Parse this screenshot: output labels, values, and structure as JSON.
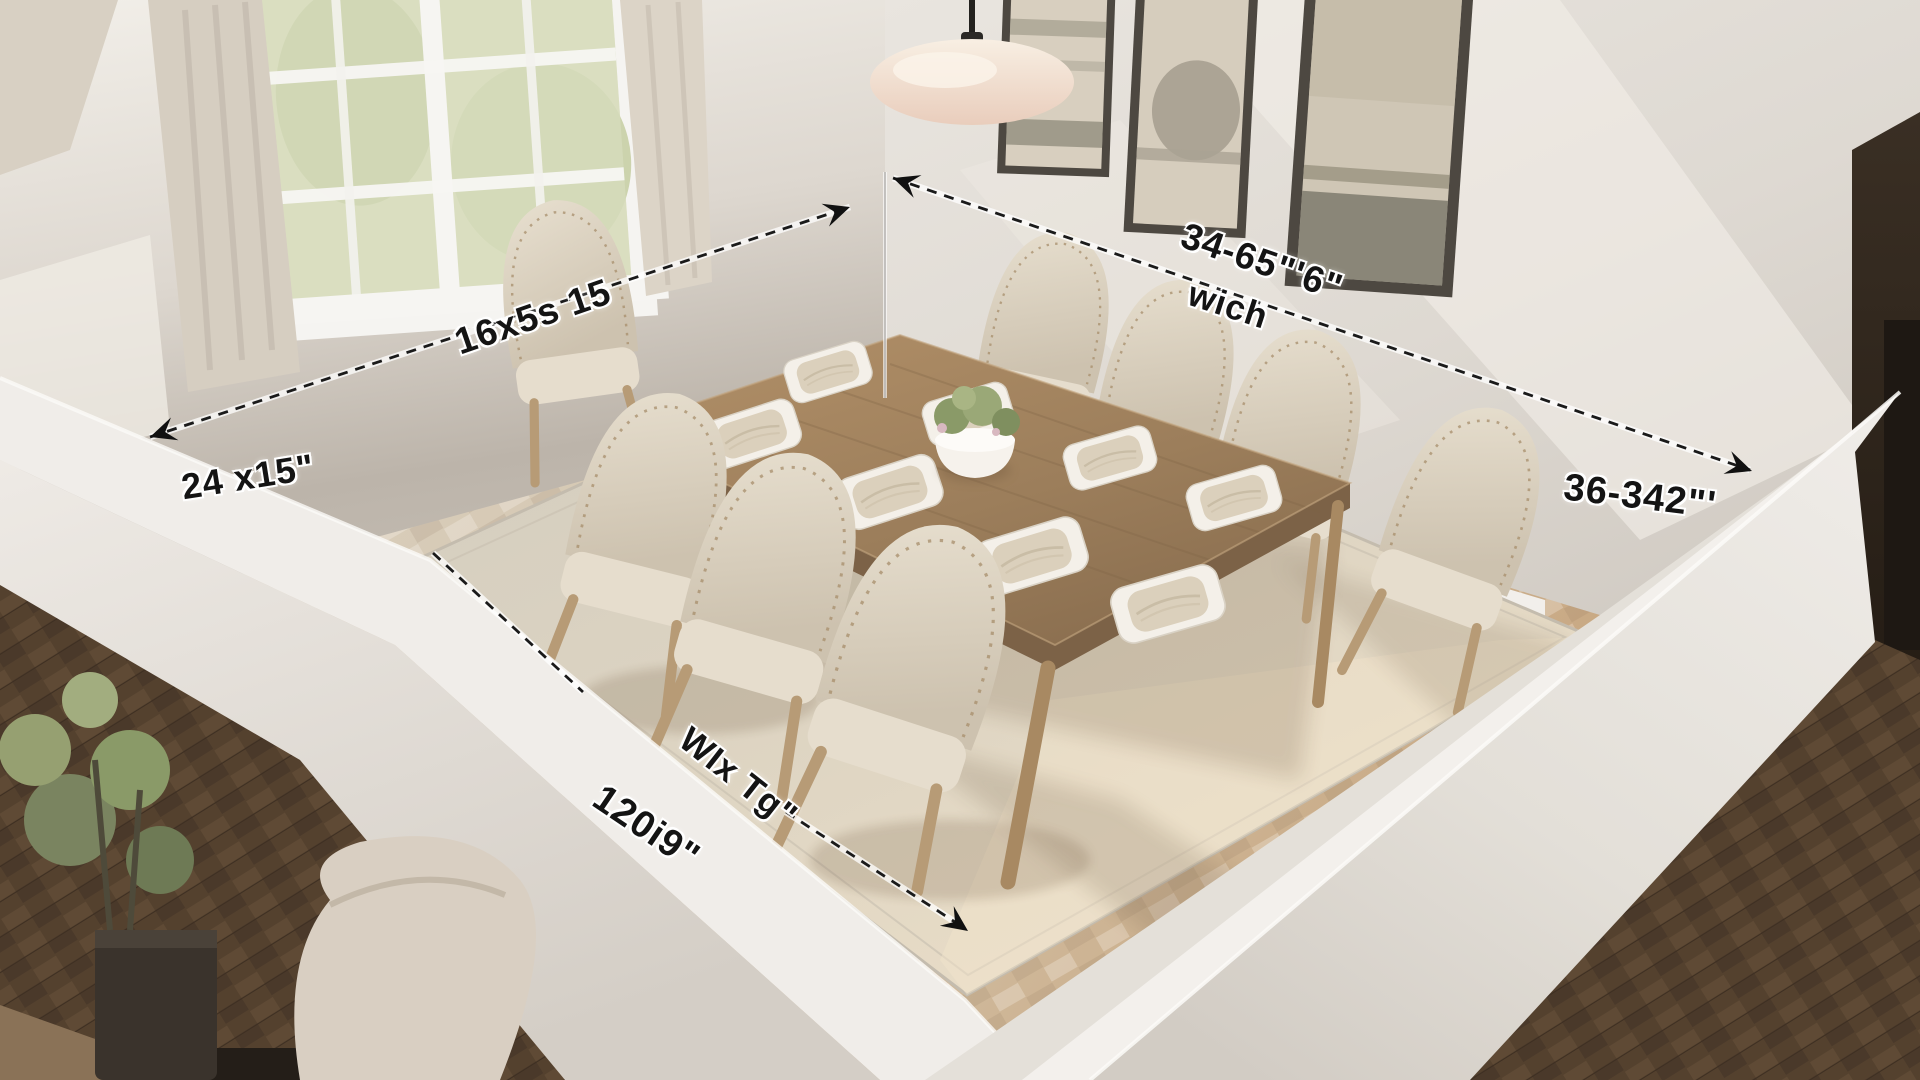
{
  "annotations": {
    "left_wall_dim_size": "16x5s 15",
    "left_wall_dim_alt": "24 x15\"",
    "right_wall_dim_size": "34-65\"'6\"",
    "right_wall_dim_word": "wich",
    "right_wall_dim_alt": "36-342\"'",
    "rug_dim_size": "WIx Tg\"",
    "rug_dim_alt": "120i9\""
  },
  "palette": {
    "wall": "#e6e2dc",
    "wall_bright": "#f3f0ec",
    "wall_shadow_taupe": "#b9b1a7",
    "floor_inside_light": "#d8cfc0",
    "floor_inside_warm": "#c49e74",
    "floor_outside_dark": "#54412e",
    "rug_cream": "#e8dfca",
    "rug_shadow": "#cfc8bb",
    "table_wood": "#a0815f",
    "chair_fabric": "#ddd3c2",
    "leg_wood": "#b79b76",
    "dimension_line": "#1a1a1a",
    "label_text": "#141414",
    "lamp_shade": "#f3e2d3",
    "art_frame": "#4d4841",
    "window_view_green": "#ccd2a8",
    "curtain": "#d8d0c3",
    "plant_green": "#8a9a68",
    "doorway_dark": "#2f261d"
  }
}
